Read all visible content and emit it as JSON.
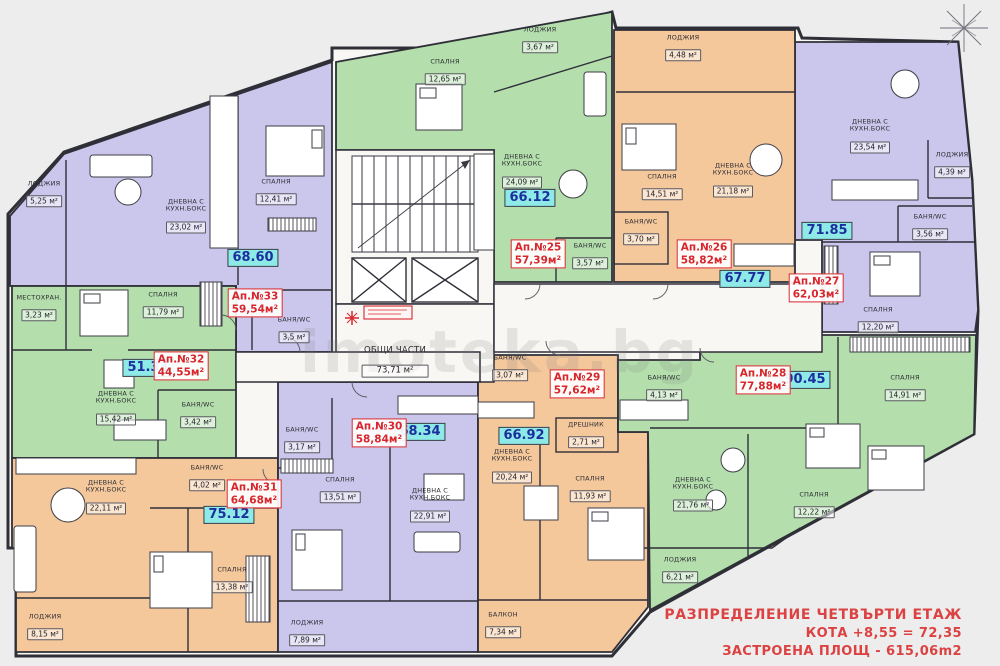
{
  "floor": {
    "watermark": "imoteka.bg",
    "common": {
      "name": "общи части",
      "area": "73,71 м²"
    },
    "colors": {
      "purple": "#cac6ec",
      "green": "#b4dfad",
      "orange": "#f5c89c",
      "building": "#f8f7f4",
      "wall": "#2f2f38",
      "label_teal_bg": "#8deae6",
      "label_teal_text": "#1c2f9e",
      "label_red": "#d8262c",
      "title_red": "#dc4242"
    },
    "apartments": {
      "apt25": {
        "no": "Ап.№25",
        "area": "57,39м²",
        "total": "66.12",
        "rooms": {
          "loggia": {
            "name": "лоджия",
            "area": "3,67 м²"
          },
          "bedroom": {
            "name": "спалня",
            "area": "12,65 м²"
          },
          "living": {
            "name": "дневна с кухн.бокс",
            "area": "24,09 м²"
          },
          "bath": {
            "name": "баня/wc",
            "area": "3,57 м²"
          }
        }
      },
      "apt26": {
        "no": "Ап.№26",
        "area": "58,82м²",
        "total": "67.77",
        "rooms": {
          "loggia": {
            "name": "лоджия",
            "area": "4,48 м²"
          },
          "bedroom": {
            "name": "спалня",
            "area": "14,51 м²"
          },
          "living": {
            "name": "дневна с кухн.бокс",
            "area": "21,18 м²"
          },
          "bath": {
            "name": "баня/wc",
            "area": "3,70 м²"
          }
        }
      },
      "apt27": {
        "no": "Ап.№27",
        "area": "62,03м²",
        "total": "71.85",
        "rooms": {
          "living": {
            "name": "дневна с кухн.бокс",
            "area": "23,54 м²"
          },
          "loggia": {
            "name": "лоджия",
            "area": "4,39 м²"
          },
          "bath": {
            "name": "баня/wc",
            "area": "3,56 м²"
          },
          "bedroom": {
            "name": "спалня",
            "area": "12,20 м²"
          }
        }
      },
      "apt28": {
        "no": "Ап.№28",
        "area": "77,88м²",
        "total": "90.45",
        "rooms": {
          "bedroom1": {
            "name": "спалня",
            "area": "14,91 м²"
          },
          "bedroom2": {
            "name": "спалня",
            "area": "12,22 м²"
          },
          "living": {
            "name": "дневна с кухн.бокс",
            "area": "21,76 м²"
          },
          "loggia": {
            "name": "лоджия",
            "area": "6,21 м²"
          },
          "bath": {
            "name": "баня/wc",
            "area": "4,13 м²"
          }
        }
      },
      "apt29": {
        "no": "Ап.№29",
        "area": "57,62м²",
        "total": "66.92",
        "rooms": {
          "living": {
            "name": "дневна с кухн.бокс",
            "area": "20,24 м²"
          },
          "dresser": {
            "name": "дрешник",
            "area": "2,71 м²"
          },
          "bedroom": {
            "name": "спалня",
            "area": "11,93 м²"
          },
          "bath": {
            "name": "баня/wc",
            "area": "3,07 м²"
          },
          "balcony": {
            "name": "балкон",
            "area": "7,34 м²"
          }
        }
      },
      "apt30": {
        "no": "Ап.№30",
        "area": "58,84м²",
        "total": "68.34",
        "rooms": {
          "bath": {
            "name": "баня/wc",
            "area": "3,17 м²"
          },
          "bedroom": {
            "name": "спалня",
            "area": "13,51 м²"
          },
          "living": {
            "name": "дневна с кухн.бокс",
            "area": "22,91 м²"
          },
          "loggia": {
            "name": "лоджия",
            "area": "7,89 м²"
          }
        }
      },
      "apt31": {
        "no": "Ап.№31",
        "area": "64,68м²",
        "total": "75.12",
        "rooms": {
          "living": {
            "name": "дневна с кухн.бокс",
            "area": "22,11 м²"
          },
          "bath": {
            "name": "баня/wc",
            "area": "4,02 м²"
          },
          "bedroom": {
            "name": "спалня",
            "area": "13,38 м²"
          },
          "loggia": {
            "name": "лоджия",
            "area": "8,15 м²"
          }
        }
      },
      "apt32": {
        "no": "Ап.№32",
        "area": "44,55м²",
        "total": "51.33",
        "rooms": {
          "storage": {
            "name": "местохран.",
            "area": "3,23 м²"
          },
          "bedroom": {
            "name": "спалня",
            "area": "11,79 м²"
          },
          "living": {
            "name": "дневна с кухн.бокс",
            "area": "15,42 м²"
          },
          "bath": {
            "name": "баня/wc",
            "area": "3,42 м²"
          }
        }
      },
      "apt33": {
        "no": "Ап.№33",
        "area": "59,54м²",
        "total": "68.60",
        "rooms": {
          "loggia": {
            "name": "лоджия",
            "area": "5,25 м²"
          },
          "bedroom": {
            "name": "спалня",
            "area": "12,41 м²"
          },
          "living": {
            "name": "дневна с кухн.бокс",
            "area": "23,02 м²"
          },
          "bath": {
            "name": "баня/wc",
            "area": "3,5 м²"
          }
        }
      }
    },
    "title_block": {
      "line1": "РАЗПРЕДЕЛЕНИЕ  ЧЕТВЪРТИ ЕТАЖ",
      "line2": "КОТА +8,55 = 72,35",
      "line3": "ЗАСТРОЕНА ПЛОЩ - 615,06m2"
    }
  }
}
